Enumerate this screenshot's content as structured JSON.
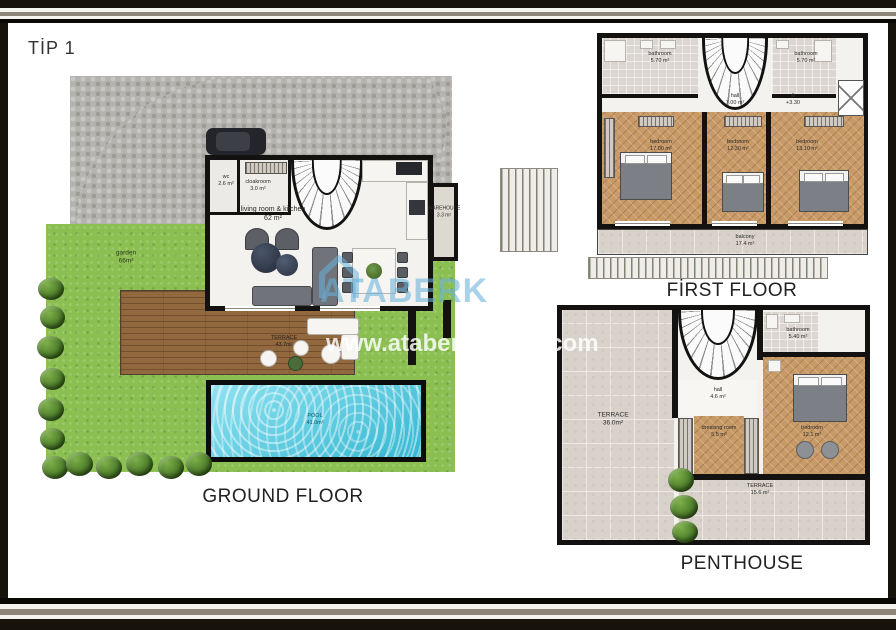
{
  "title": "TİP 1",
  "watermark": {
    "brand": "ATABERK",
    "url": "www.ataberkestate.com"
  },
  "colors": {
    "frame": "#17130a",
    "stripe": "#8d8679",
    "wall": "#141210",
    "grass": "#8cbf52",
    "pool_water": "#4cc8e0",
    "deck_wood": "#92683f",
    "floor_wood": "#c89a67",
    "tile": "#d8d2ca",
    "watermark_blue": "#69b2da"
  },
  "ground_floor": {
    "caption": "GROUND FLOOR",
    "wc": {
      "name": "wc",
      "area": "2.6 m²"
    },
    "cloakroom": {
      "name": "cloakroom",
      "area": "3.0 m²"
    },
    "living": {
      "name": "living room & kitchen",
      "area": "62 m²"
    },
    "warehouse": {
      "name": "WAREHOUSE",
      "area": "3.3 m²"
    },
    "garden": {
      "name": "garden",
      "area": "66m²"
    },
    "terrace": {
      "name": "TERRACE",
      "area": "43.7m²"
    },
    "pool": {
      "name": "POOL",
      "area": "41.0m²"
    }
  },
  "first_floor": {
    "caption": "FİRST FLOOR",
    "bathroom_left": {
      "name": "bathroom",
      "area": "5.70 m²"
    },
    "bathroom_right": {
      "name": "bathroom",
      "area": "5.70 m²"
    },
    "hall": {
      "name": "hall",
      "area": "7.00 m²"
    },
    "level_mark": "+3.30",
    "bedroom_left": {
      "name": "bedroom",
      "area": "17.00 m²"
    },
    "bedroom_mid": {
      "name": "bedroom",
      "area": "12.30 m²"
    },
    "bedroom_right": {
      "name": "bedroom",
      "area": "13.10 m²"
    },
    "balcony": {
      "name": "balcony",
      "area": "17.4 m²"
    }
  },
  "penthouse": {
    "caption": "PENTHOUSE",
    "terrace_main": {
      "name": "TERRACE",
      "area": "36.0m²"
    },
    "bathroom": {
      "name": "bathroom",
      "area": "5.40 m²"
    },
    "hall": {
      "name": "hall",
      "area": "4.6 m²"
    },
    "dressing": {
      "name": "dressing room",
      "area": "5.5 m²"
    },
    "bedroom": {
      "name": "bedroom",
      "area": "12.1 m²"
    },
    "terrace_small": {
      "name": "TERRACE",
      "area": "15.6 m²"
    }
  }
}
